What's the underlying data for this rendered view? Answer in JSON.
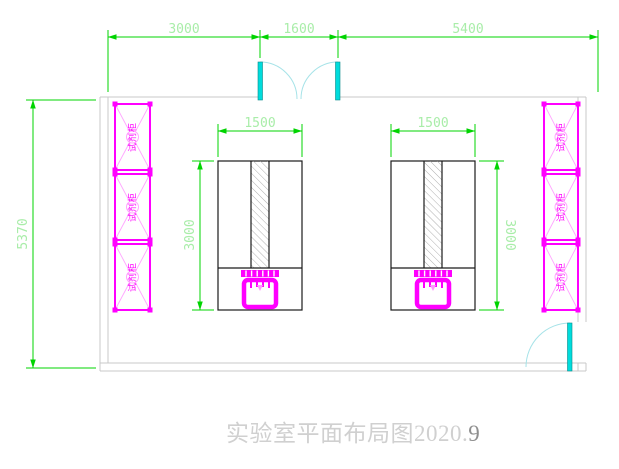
{
  "title": {
    "main": "实验室平面布局图2020.",
    "suffix": "9"
  },
  "dimensions": {
    "top_left": "3000",
    "top_middle": "1600",
    "top_right": "5400",
    "room_height": "5370",
    "bench1_width": "1500",
    "bench2_width": "1500",
    "bench1_depth": "3000",
    "bench2_depth": "3000"
  },
  "cabinets": {
    "left": [
      {
        "label": "试剂柜"
      },
      {
        "label": "试剂柜"
      },
      {
        "label": "试剂柜"
      }
    ],
    "right": [
      {
        "label": "试剂柜"
      },
      {
        "label": "试剂柜"
      },
      {
        "label": "试剂柜"
      }
    ]
  },
  "colors": {
    "dimension_line": "#00d400",
    "dimension_text": "#a9eda9",
    "cabinet": "#ff00ff",
    "cabinet_light": "#ffa6ff",
    "door_leaf": "#00dcdc",
    "door_arc": "#a6e3e8",
    "wall": "#c9c9c9",
    "bench_line": "#1a1a1a",
    "title_text": "#d0d0d0"
  }
}
